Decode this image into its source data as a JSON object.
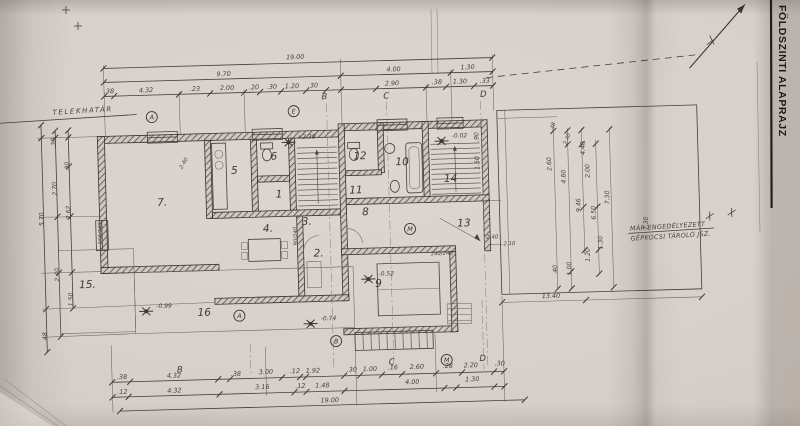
{
  "sheet": {
    "title": "FÖLDSZINTI ALAPRAJZ",
    "boundary_label": "TELEKHATÁR",
    "paper_color": "#d7cfc9",
    "ink_color": "#453e38"
  },
  "note": {
    "l1": "MÁR ENGEDÉLYEZETT",
    "l2": "GÉPKOCSI TÁROLÓ JSZ."
  },
  "rooms": [
    {
      "n": "7.",
      "x": 163,
      "y": 202,
      "fs": 12
    },
    {
      "n": "5",
      "x": 236,
      "y": 172
    },
    {
      "n": "6",
      "x": 276,
      "y": 159
    },
    {
      "n": "1",
      "x": 280,
      "y": 197
    },
    {
      "n": "3.",
      "x": 307,
      "y": 225
    },
    {
      "n": "12",
      "x": 362,
      "y": 161
    },
    {
      "n": "10",
      "x": 404,
      "y": 168
    },
    {
      "n": "11",
      "x": 357,
      "y": 195
    },
    {
      "n": "14",
      "x": 452,
      "y": 186
    },
    {
      "n": "4.",
      "x": 268,
      "y": 231
    },
    {
      "n": "2.",
      "x": 318,
      "y": 257
    },
    {
      "n": "8",
      "x": 366,
      "y": 217
    },
    {
      "n": "13",
      "x": 464,
      "y": 231
    },
    {
      "n": "9",
      "x": 377,
      "y": 289
    },
    {
      "n": "16",
      "x": 202,
      "y": 313
    },
    {
      "n": "15.",
      "x": 86,
      "y": 282
    }
  ],
  "dims": {
    "h": [
      {
        "t": "19.00",
        "x": 300,
        "y": 59,
        "fs": 7
      },
      {
        "t": "9.70",
        "x": 228,
        "y": 74
      },
      {
        "t": "4.00",
        "x": 398,
        "y": 74
      },
      {
        "t": "1.30",
        "x": 472,
        "y": 74
      },
      {
        "t": ".38",
        "x": 113,
        "y": 88
      },
      {
        "t": "4.32",
        "x": 150,
        "y": 88
      },
      {
        "t": ".23",
        "x": 199,
        "y": 88
      },
      {
        "t": "2.00",
        "x": 231,
        "y": 88
      },
      {
        "t": ".20",
        "x": 258,
        "y": 88
      },
      {
        "t": ".30",
        "x": 276,
        "y": 88
      },
      {
        "t": "1.20",
        "x": 296,
        "y": 88
      },
      {
        "t": ".30",
        "x": 317,
        "y": 88
      },
      {
        "t": "2.90",
        "x": 396,
        "y": 88
      },
      {
        "t": ".38",
        "x": 441,
        "y": 88
      },
      {
        "t": "1.30",
        "x": 464,
        "y": 88
      },
      {
        "t": ".33",
        "x": 489,
        "y": 88
      },
      {
        "t": ".38",
        "x": 118,
        "y": 374
      },
      {
        "t": "4.32",
        "x": 170,
        "y": 374
      },
      {
        "t": ".38",
        "x": 232,
        "y": 374
      },
      {
        "t": "3.00",
        "x": 262,
        "y": 373
      },
      {
        "t": ".12",
        "x": 291,
        "y": 373
      },
      {
        "t": "1.92",
        "x": 309,
        "y": 373
      },
      {
        "t": ".30",
        "x": 348,
        "y": 373
      },
      {
        "t": "1.00",
        "x": 366,
        "y": 373
      },
      {
        "t": ".16",
        "x": 389,
        "y": 372
      },
      {
        "t": "2.60",
        "x": 413,
        "y": 372
      },
      {
        "t": ".28",
        "x": 444,
        "y": 372
      },
      {
        "t": "2.20",
        "x": 467,
        "y": 372
      },
      {
        "t": ".30",
        "x": 496,
        "y": 371
      },
      {
        "t": ".12",
        "x": 118,
        "y": 389
      },
      {
        "t": "4.32",
        "x": 170,
        "y": 389
      },
      {
        "t": "3.16",
        "x": 258,
        "y": 388
      },
      {
        "t": ".12",
        "x": 296,
        "y": 388
      },
      {
        "t": "1.48",
        "x": 318,
        "y": 388
      },
      {
        "t": "4.00",
        "x": 408,
        "y": 387
      },
      {
        "t": "1.30",
        "x": 468,
        "y": 386
      },
      {
        "t": "19.00",
        "x": 325,
        "y": 403,
        "fs": 7
      },
      {
        "t": "13.40",
        "x": 549,
        "y": 305
      }
    ],
    "v": [
      {
        "t": ".30",
        "x": 58,
        "y": 136
      },
      {
        "t": "2.70",
        "x": 58,
        "y": 182
      },
      {
        "t": "2.40",
        "x": 58,
        "y": 268
      },
      {
        "t": "5.70",
        "x": 44,
        "y": 212
      },
      {
        "t": ".48",
        "x": 44,
        "y": 330
      },
      {
        "t": "2.62",
        "x": 71,
        "y": 206
      },
      {
        "t": "1.50",
        "x": 71,
        "y": 293
      },
      {
        "t": ".30",
        "x": 71,
        "y": 160
      },
      {
        "t": ".90",
        "x": 481,
        "y": 142
      },
      {
        "t": "1.50",
        "x": 481,
        "y": 168
      },
      {
        "t": "2.60",
        "x": 553,
        "y": 171
      },
      {
        "t": "4.60",
        "x": 567,
        "y": 184
      },
      {
        "t": "4.40",
        "x": 587,
        "y": 156
      },
      {
        "t": "2.00",
        "x": 591,
        "y": 179
      },
      {
        "t": "9.46",
        "x": 581,
        "y": 213
      },
      {
        "t": "6.50",
        "x": 596,
        "y": 221
      },
      {
        "t": "1.30",
        "x": 602,
        "y": 251
      },
      {
        "t": "7.30",
        "x": 610,
        "y": 206
      },
      {
        "t": "7.30",
        "x": 648,
        "y": 233
      },
      {
        "t": "1.20",
        "x": 589,
        "y": 263
      },
      {
        "t": "1.00",
        "x": 570,
        "y": 276
      },
      {
        "t": ".40",
        "x": 556,
        "y": 277
      }
    ],
    "small": [
      {
        "t": "90/240",
        "x": 297,
        "y": 236,
        "r": -90
      },
      {
        "t": "150/240",
        "x": 102,
        "y": 228,
        "r": -90
      },
      {
        "t": "2.40",
        "x": 187,
        "y": 161,
        "r": -58
      },
      {
        "t": "140/240",
        "x": 441,
        "y": 259,
        "r": 0
      },
      {
        "t": "2.40",
        "x": 492,
        "y": 244,
        "r": 0
      },
      {
        "t": "2.10",
        "x": 509,
        "y": 251,
        "r": 0
      },
      {
        "t": "2.40",
        "x": 571,
        "y": 147,
        "r": -68
      },
      {
        "t": ".48",
        "x": 557,
        "y": 134,
        "r": -68
      }
    ]
  },
  "levels": [
    {
      "t": "+2.38",
      "x": 307,
      "y": 139
    },
    {
      "t": "-0.02",
      "x": 460,
      "y": 142
    },
    {
      "t": "-0.52",
      "x": 383,
      "y": 278
    },
    {
      "t": "-0.74",
      "x": 324,
      "y": 321
    },
    {
      "t": "-0.99",
      "x": 160,
      "y": 304
    }
  ],
  "markers": [
    {
      "t": "A",
      "x": 155,
      "y": 113
    },
    {
      "t": "E",
      "x": 297,
      "y": 111
    },
    {
      "t": "M",
      "x": 410,
      "y": 232
    },
    {
      "t": "A",
      "x": 237,
      "y": 314
    },
    {
      "t": "B",
      "x": 333,
      "y": 342
    },
    {
      "t": "M",
      "x": 443,
      "y": 364
    }
  ],
  "sections": [
    {
      "t": "B",
      "x": 328,
      "y": 100
    },
    {
      "t": "C",
      "x": 390,
      "y": 101
    },
    {
      "t": "D",
      "x": 487,
      "y": 102
    },
    {
      "t": "B",
      "x": 176,
      "y": 369
    },
    {
      "t": "C",
      "x": 388,
      "y": 367
    },
    {
      "t": "D",
      "x": 479,
      "y": 366
    }
  ]
}
